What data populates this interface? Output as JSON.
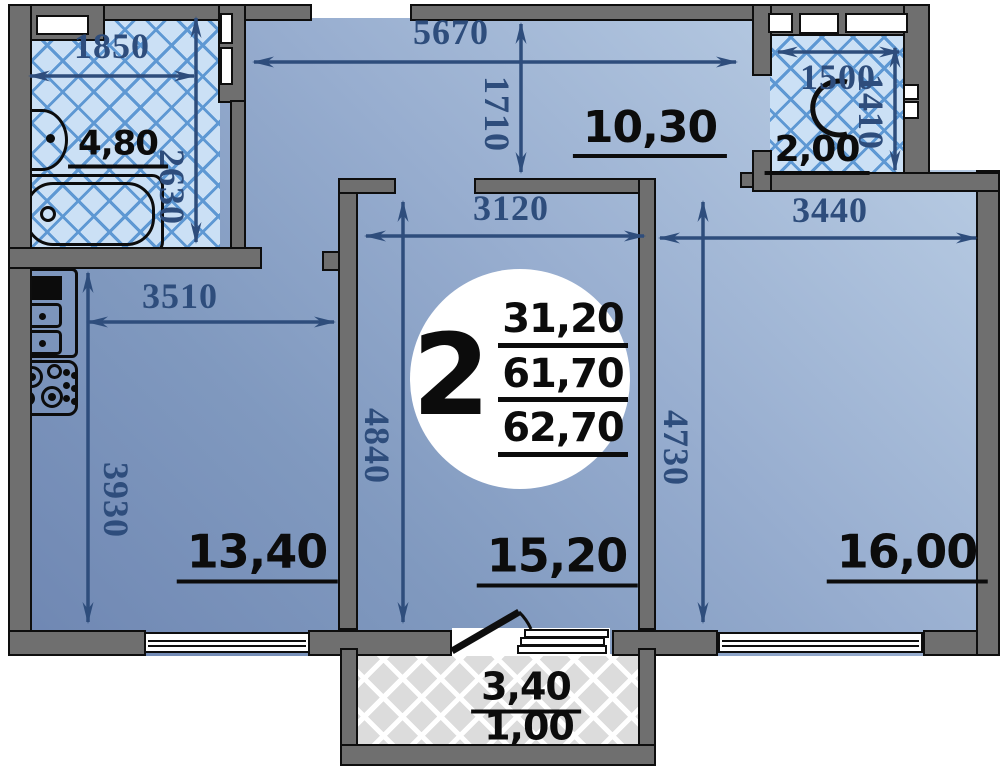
{
  "plan": {
    "unit": {
      "rooms_count": "2"
    },
    "summary": {
      "living_area": "31,20",
      "usable_area": "61,70",
      "total_area": "62,70"
    },
    "rooms": {
      "bathroom": {
        "area": "4,80",
        "width_mm": "1850",
        "height_mm": "2630"
      },
      "hallway": {
        "area": "10,30",
        "width_mm": "5670",
        "height_mm": "1710"
      },
      "wc": {
        "area": "2,00",
        "width_mm": "1500",
        "height_mm": "1410"
      },
      "kitchen": {
        "area": "13,40",
        "width_mm": "3510",
        "height_mm": "3930"
      },
      "living_room": {
        "area": "15,20",
        "width_mm": "3120",
        "height_mm": "4840"
      },
      "bedroom": {
        "area": "16,00",
        "width_mm": "3440",
        "height_mm": "4730"
      },
      "balcony": {
        "area_full": "3,40",
        "area_counted": "1,00"
      }
    },
    "colors": {
      "dimension_text": "#2e4d7c",
      "wall_fill": "#6f6f6f",
      "outline": "#0e0e0e",
      "tile_bg": "#cbe0f5",
      "tile_line": "#5e98d3",
      "room_gradient_dark": "#6e86b2",
      "room_gradient_light": "#bfd2e8"
    }
  }
}
